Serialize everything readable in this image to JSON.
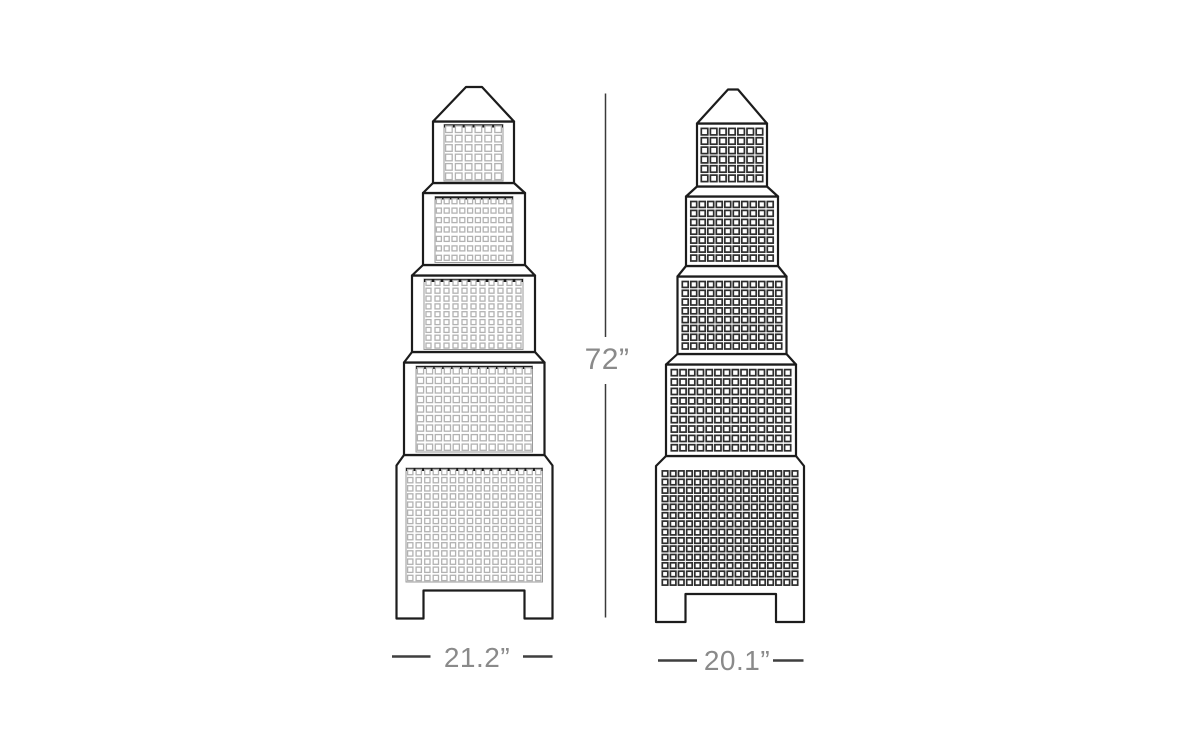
{
  "canvas": {
    "width": 1200,
    "height": 736,
    "background": "#ffffff"
  },
  "dimensions": {
    "height_label": "72”",
    "front_width_label": "21.2”",
    "side_width_label": "20.1”"
  },
  "colors": {
    "outline": "#1c1c1c",
    "front_windows": "#b2b2b2",
    "side_windows": "#2d2d2d",
    "dimension_line": "#3a3a3a",
    "dimension_text": "#8a8a8a",
    "background": "#ffffff"
  },
  "figure": {
    "subject": "Five-tier skyscraper tower dimension drawing, front and side views with pyramid top and notched leg base",
    "towers": [
      {
        "id": "front",
        "view": "front",
        "frame": true,
        "frameColor": "#9a9a9a",
        "topEdgeColor": "#1c1c1c",
        "squareColor": "#b2b2b2",
        "squareStroke": 1.3,
        "gap": 2.8,
        "panels": [
          {
            "tier": 1,
            "x": 444,
            "y": 124.5,
            "w": 59,
            "h": 56.5,
            "cols": 6,
            "rows": 6
          },
          {
            "tier": 2,
            "x": 435,
            "y": 196.5,
            "w": 78,
            "h": 66,
            "cols": 10,
            "rows": 7
          },
          {
            "tier": 3,
            "x": 424,
            "y": 279,
            "w": 99,
            "h": 70.5,
            "cols": 11,
            "rows": 9
          },
          {
            "tier": 4,
            "x": 416,
            "y": 366,
            "w": 116.5,
            "h": 86,
            "cols": 13,
            "rows": 9
          },
          {
            "tier": 5,
            "x": 406,
            "y": 468,
            "w": 136.5,
            "h": 114,
            "cols": 16,
            "rows": 14
          }
        ]
      },
      {
        "id": "side",
        "view": "side",
        "frame": false,
        "squareColor": "#2d2d2d",
        "squareStroke": 1.7,
        "gap": 2.6,
        "panels": [
          {
            "tier": 1,
            "x": 700,
            "y": 127,
            "w": 64,
            "h": 56,
            "cols": 7,
            "rows": 6
          },
          {
            "tier": 2,
            "x": 689.5,
            "y": 200,
            "w": 85,
            "h": 62.5,
            "cols": 10,
            "rows": 7
          },
          {
            "tier": 3,
            "x": 681,
            "y": 280,
            "w": 102,
            "h": 70.5,
            "cols": 12,
            "rows": 8
          },
          {
            "tier": 4,
            "x": 670,
            "y": 368,
            "w": 122,
            "h": 84.5,
            "cols": 14,
            "rows": 9
          },
          {
            "tier": 5,
            "x": 661,
            "y": 469.5,
            "w": 138,
            "h": 117,
            "cols": 17,
            "rows": 14
          }
        ]
      }
    ]
  }
}
